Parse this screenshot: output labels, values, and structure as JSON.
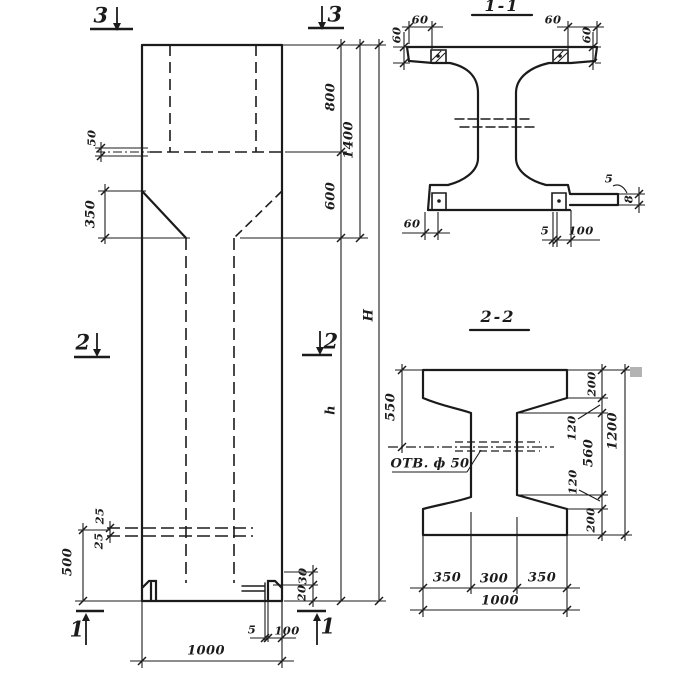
{
  "sheet": {
    "background": "#ffffff",
    "ink": "#1b1b1b"
  },
  "elevation": {
    "marker_3": "3",
    "marker_2": "2",
    "marker_1": "1",
    "dim_50": "50",
    "dim_350": "350",
    "dim_800": "800",
    "dim_600": "600",
    "dim_1400": "1400",
    "dim_h": "h",
    "dim_H": "H",
    "dim_25_top": "25",
    "dim_25_bottom": "25",
    "dim_500": "500",
    "dim_30": "30",
    "dim_20": "20",
    "dim_5_foot": "5",
    "dim_100_foot": "100",
    "dim_1000": "1000"
  },
  "section_1_1": {
    "title": "1-1",
    "dim_60_top_left": "60",
    "dim_60_left_vert": "60",
    "dim_60_top_right": "60",
    "dim_60_right_vert": "60",
    "dim_60_bottom_left": "60",
    "dim_5_bottom": "5",
    "dim_100_bottom": "100",
    "dim_5_hook": "5",
    "dim_8_plate": "8"
  },
  "section_2_2": {
    "title": "2-2",
    "hole_label": "ОТВ. ф 50",
    "dim_550": "550",
    "dim_200_top": "200",
    "dim_120_top": "120",
    "dim_560": "560",
    "dim_120_bottom": "120",
    "dim_200_bottom": "200",
    "dim_1200": "1200",
    "dim_350_left": "350",
    "dim_300": "300",
    "dim_350_right": "350",
    "dim_1000": "1000"
  }
}
